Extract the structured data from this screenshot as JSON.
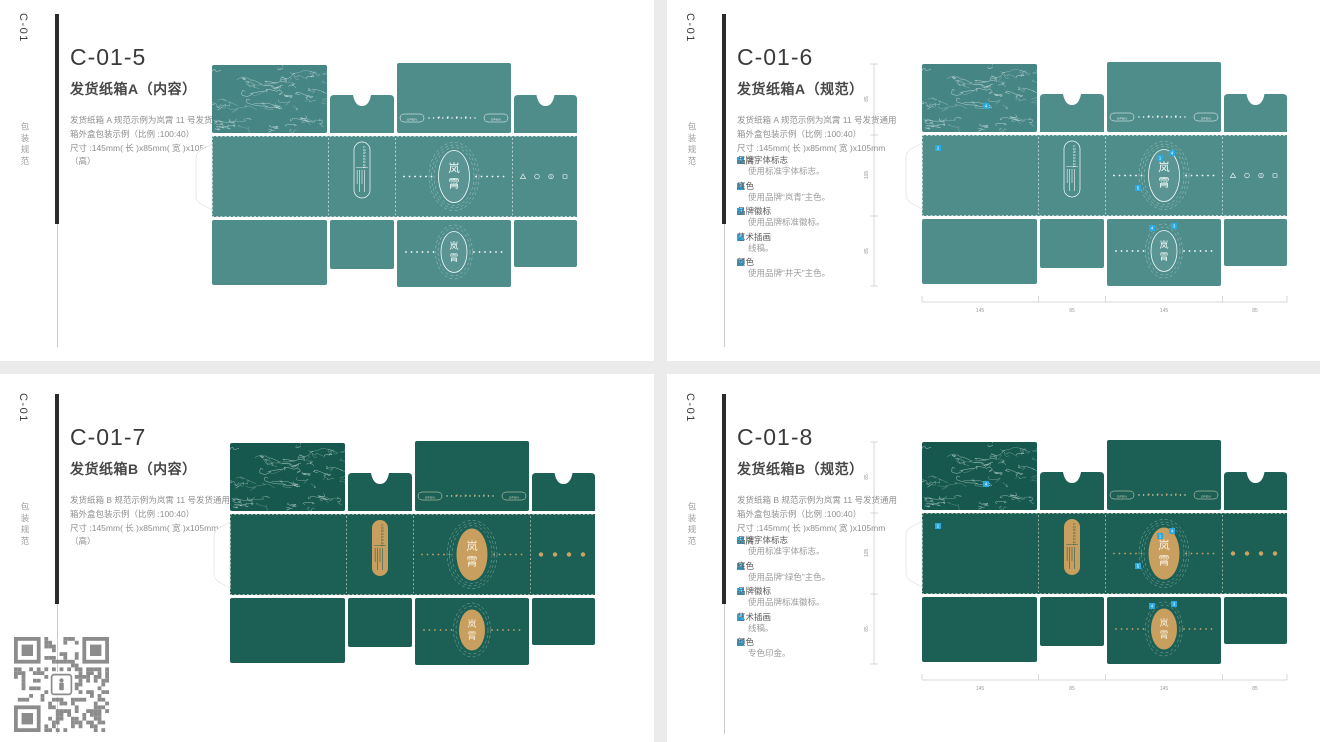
{
  "page": {
    "bg": "#ebebeb",
    "card_bg": "#ffffff"
  },
  "panels": [
    {
      "code": "C-01",
      "side_label": "包装规范",
      "title": "C-01-5",
      "subtitle": "发货纸箱A（内容）",
      "desc1": "发货纸箱 A 规范示例为岚霄 11 号发货通用箱外盒包装示例（比例 :100:40）",
      "desc2": "尺寸 :145mm( 长 )x85mm( 宽 )x105mm（高）",
      "variant": "teal",
      "spec": false,
      "annotations": []
    },
    {
      "code": "C-01",
      "side_label": "包装规范",
      "title": "C-01-6",
      "subtitle": "发货纸箱A（规范）",
      "desc1": "发货纸箱 A 规范示例为岚霄 11 号发货通用箱外盒包装示例（比例 :100:40）",
      "desc2": "尺寸 :145mm( 长 )x85mm( 宽 )x105mm（高）",
      "variant": "teal",
      "spec": true,
      "annotations": [
        {
          "num": "1",
          "label": "品牌字体标志",
          "note": "使用标准字体标志。"
        },
        {
          "num": "2",
          "label": "底色",
          "note": "使用品牌“岚青”主色。"
        },
        {
          "num": "3",
          "label": "品牌徽标",
          "note": "使用品牌标准徽标。"
        },
        {
          "num": "4",
          "label": "艺术插画",
          "note": "线稿。"
        },
        {
          "num": "5",
          "label": "颜色",
          "note": "使用品牌“井天”主色。"
        }
      ]
    },
    {
      "code": "C-01",
      "side_label": "包装规范",
      "title": "C-01-7",
      "subtitle": "发货纸箱B（内容）",
      "desc1": "发货纸箱 B 规范示例为岚霄 11 号发货通用箱外盒包装示例（比例 :100:40）",
      "desc2": "尺寸 :145mm( 长 )x85mm( 宽 )x105mm（高）",
      "variant": "green",
      "spec": false,
      "annotations": []
    },
    {
      "code": "C-01",
      "side_label": "包装规范",
      "title": "C-01-8",
      "subtitle": "发货纸箱B（规范）",
      "desc1": "发货纸箱 B 规范示例为岚霄 11 号发货通用箱外盒包装示例（比例 :100:40）",
      "desc2": "尺寸 :145mm( 长 )x85mm( 宽 )x105mm（高）",
      "variant": "green",
      "spec": true,
      "annotations": [
        {
          "num": "1",
          "label": "品牌字体标志",
          "note": "使用标准字体标志。"
        },
        {
          "num": "2",
          "label": "底色",
          "note": "使用品牌“绿色”主色。"
        },
        {
          "num": "3",
          "label": "品牌徽标",
          "note": "使用品牌标准徽标。"
        },
        {
          "num": "4",
          "label": "艺术插画",
          "note": "线稿。"
        },
        {
          "num": "5",
          "label": "颜色",
          "note": "专色印金。"
        }
      ]
    }
  ],
  "dieline": {
    "logo_char_top": "岚",
    "logo_char_bottom": "霄",
    "brand_en": "LONGSOUL",
    "open_label": "OPEN",
    "marker_color": "#29abe2",
    "markers": [
      "4",
      "2",
      "1",
      "4",
      "5",
      "4",
      "3"
    ],
    "dims": {
      "vertical": [
        "85",
        "105",
        "85"
      ],
      "horizontal": [
        "145",
        "85",
        "145",
        "85"
      ]
    },
    "ruler_color": "#b5b5b5",
    "ruler_text_color": "#999999",
    "palettes": {
      "teal": {
        "panel": "#4f8d8b",
        "art_bg": "#458583",
        "art_line": "#eaf5f4",
        "line": "#ffffff",
        "badge_fill": "none",
        "badge_stroke": "#ffffff",
        "badge_text": "#ffffff",
        "oval_fill": "rgba(255,255,255,0.07)",
        "oval_stroke": "#f2faf9",
        "oval_text": "#f2faf9",
        "icon": "#ffffff",
        "dot": "#ffffff",
        "icon_style": "glyphs"
      },
      "green": {
        "panel": "#1c6055",
        "art_bg": "#16584d",
        "art_line": "#dcebe7",
        "line": "#e7e1c8",
        "badge_fill": "#c89f5e",
        "badge_stroke": "none",
        "badge_text": "#1c6055",
        "oval_fill": "#c89f5e",
        "oval_stroke": "none",
        "oval_text": "#f6eedd",
        "icon": "#cda361",
        "dot": "#cda361",
        "icon_style": "dots"
      }
    }
  },
  "qr": {
    "color": "#8c8c8c"
  }
}
